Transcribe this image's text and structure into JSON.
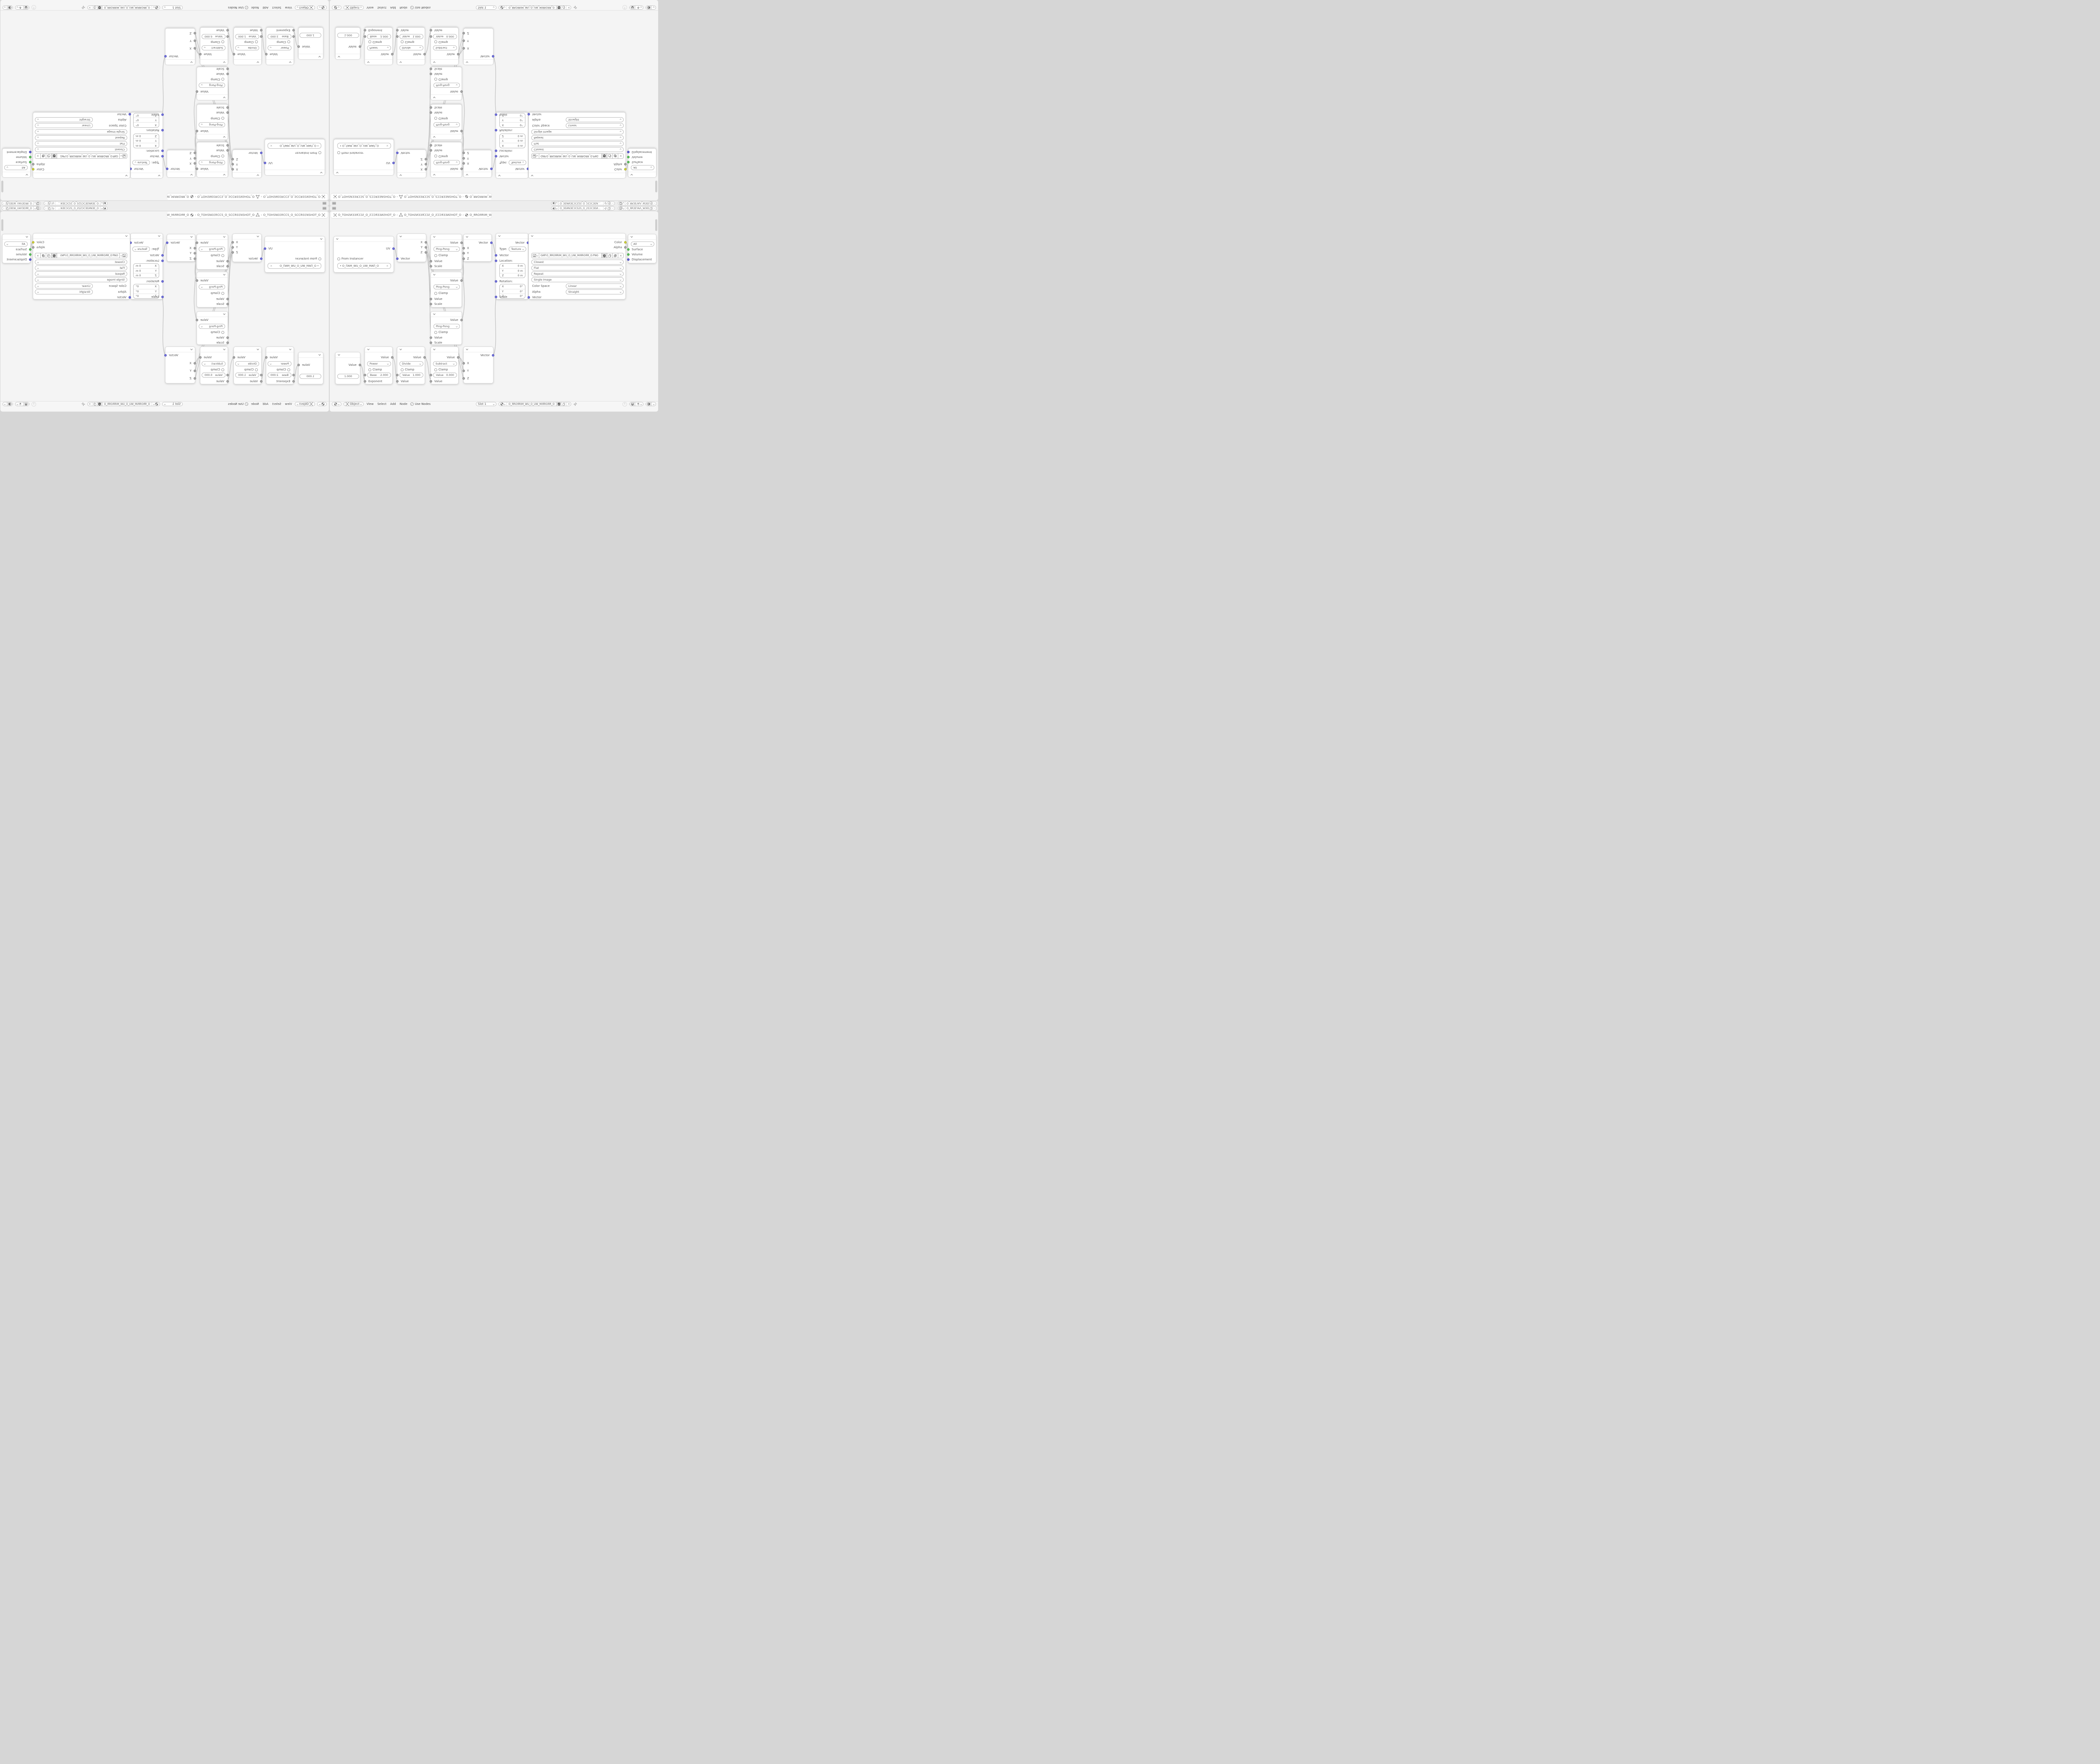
{
  "top_strip": {
    "id_selector_a": "O_ЗEИNЗEƆCS2S_O_2SƆCЗEИ…",
    "id_selector_b": "O_ЯRЗEYAΛ_WЗEIW_O_WIЗEW_ΛAYЗERЯ_O"
  },
  "breadcrumb": {
    "separator": "›",
    "scene": "O_TOHƧИЗЗЯƆƆƧ_O_ƧƆƆЯЗЗИƧHOT_O",
    "object": "O_TOHƧИЗЗЯƆƆƧ_O_ƧƆƆЯЗЗИƧHOT_O",
    "material": "O_ЯROЯRIM_WU_O_UW_MIЯROЯR_O"
  },
  "labels": {
    "value": "Value",
    "scale": "Scale",
    "clamp": "Clamp",
    "ping_pong": "Ping-Pong",
    "vector": "Vector",
    "uv": "UV",
    "x": "X",
    "y": "Y",
    "z": "Z",
    "from_instancer": "From Instancer",
    "exponent": "Exponent",
    "type": "Type:",
    "texture": "Texture",
    "location": "Location:",
    "rotation": "Rotation:",
    "meters": "0 m",
    "degrees": "0°",
    "color": "Color",
    "alpha": "Alpha",
    "color_space": "Color Space",
    "closest": "Closest",
    "flat": "Flat",
    "repeat": "Repeat",
    "single_image": "Single Image",
    "linear": "Linear",
    "straight": "Straight",
    "all": "All",
    "surface": "Surface",
    "volume": "Volume",
    "displacement": "Displacement",
    "dot": "•",
    "x_close": "×",
    "up_arrow": "↑",
    "check": "✓"
  },
  "nodes": {
    "uv_map": {
      "uv_map_name": "O_ПAM_WU_O_UW_MAП_O"
    },
    "value_node": {
      "value": "1.000"
    },
    "power": {
      "operation": "Power",
      "base_label": "Base",
      "base_value": "2.000"
    },
    "divide": {
      "operation": "Divide",
      "value_label": "Value",
      "value_value": "1.000"
    },
    "subtract": {
      "operation": "Subtract",
      "value_label": "Value",
      "value_value": "0.000"
    },
    "image_texture": {
      "filename": "GИP.O_ЯROЯRIM_WU_O_UW_MIЯROЯR_O.PNG"
    }
  },
  "header": {
    "mode": "Object",
    "menus": [
      "View",
      "Select",
      "Add",
      "Node"
    ],
    "use_nodes": "Use Nodes",
    "slot": "Slot 1",
    "material": "O_ЯROЯRIM_WU_O_UW_MIЯROЯR_O"
  },
  "colors": {
    "socket_value": "#a8a8a8",
    "socket_vector": "#6e6edd",
    "socket_color": "#cfcf3a",
    "socket_shader": "#5abf5a",
    "socket_displacement": "#5e5ed2",
    "editor_bg": "#f4f4f4",
    "node_bg": "#ffffff",
    "wire": "#c4c4c4"
  }
}
